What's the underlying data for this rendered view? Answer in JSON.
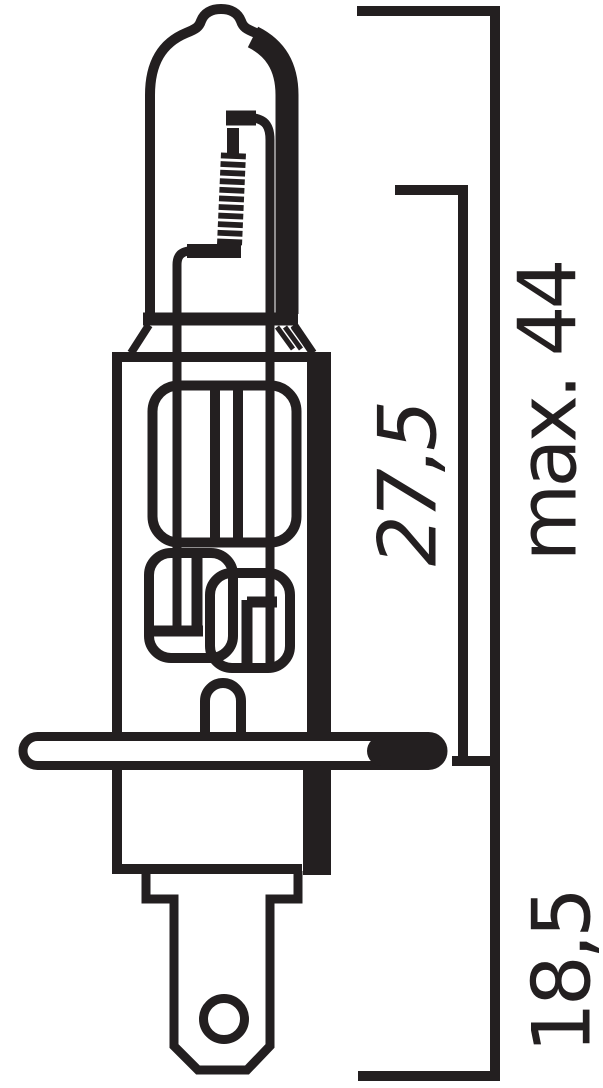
{
  "drawing": {
    "ink_color": "#231f20",
    "background_color": "#ffffff",
    "dimensions": {
      "overall_length": {
        "label": "max. 44"
      },
      "glass_length": {
        "label": "27,5"
      },
      "base_length": {
        "label": "18,5"
      }
    }
  }
}
